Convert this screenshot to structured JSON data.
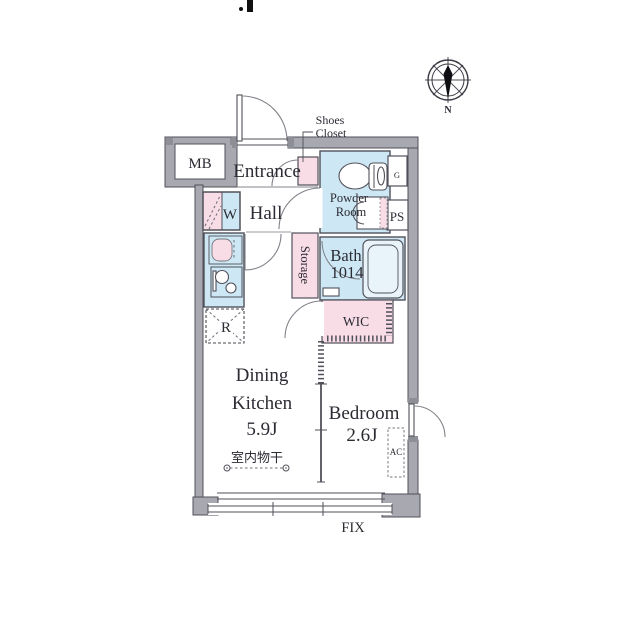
{
  "colors": {
    "background": "#ffffff",
    "wall_fill": "#a8a8b0",
    "wall_dark": "#8e8e96",
    "outline": "#50505a",
    "water_blue": "#cde8f4",
    "closet_pink": "#f8dce6",
    "door_arc": "#82828a",
    "muted": "#6b6b73",
    "text_color": "#2b2b33"
  },
  "compass": {
    "north_label": "N"
  },
  "rooms": {
    "dining_kitchen": {
      "name_line1": "Dining",
      "name_line2": "Kitchen",
      "size": "5.9J"
    },
    "bedroom": {
      "name": "Bedroom",
      "size": "2.6J"
    },
    "bath": {
      "name": "Bath",
      "size": "1014"
    },
    "powder_room": {
      "name_line1": "Powder",
      "name_line2": "Room"
    },
    "entrance": {
      "name": "Entrance"
    },
    "hall": {
      "name": "Hall"
    },
    "storage": {
      "name": "Storage"
    },
    "wic": {
      "name": "WIC"
    },
    "shoes_closet": {
      "name_line1": "Shoes",
      "name_line2": "Closet"
    }
  },
  "fixtures": {
    "meter_box": "MB",
    "washer": "W",
    "gas_meter": "G",
    "pipe_space": "PS",
    "refrigerator": "R",
    "air_conditioner": "AC",
    "fixed_window": "FIX",
    "indoor_drying": "室内物干"
  }
}
